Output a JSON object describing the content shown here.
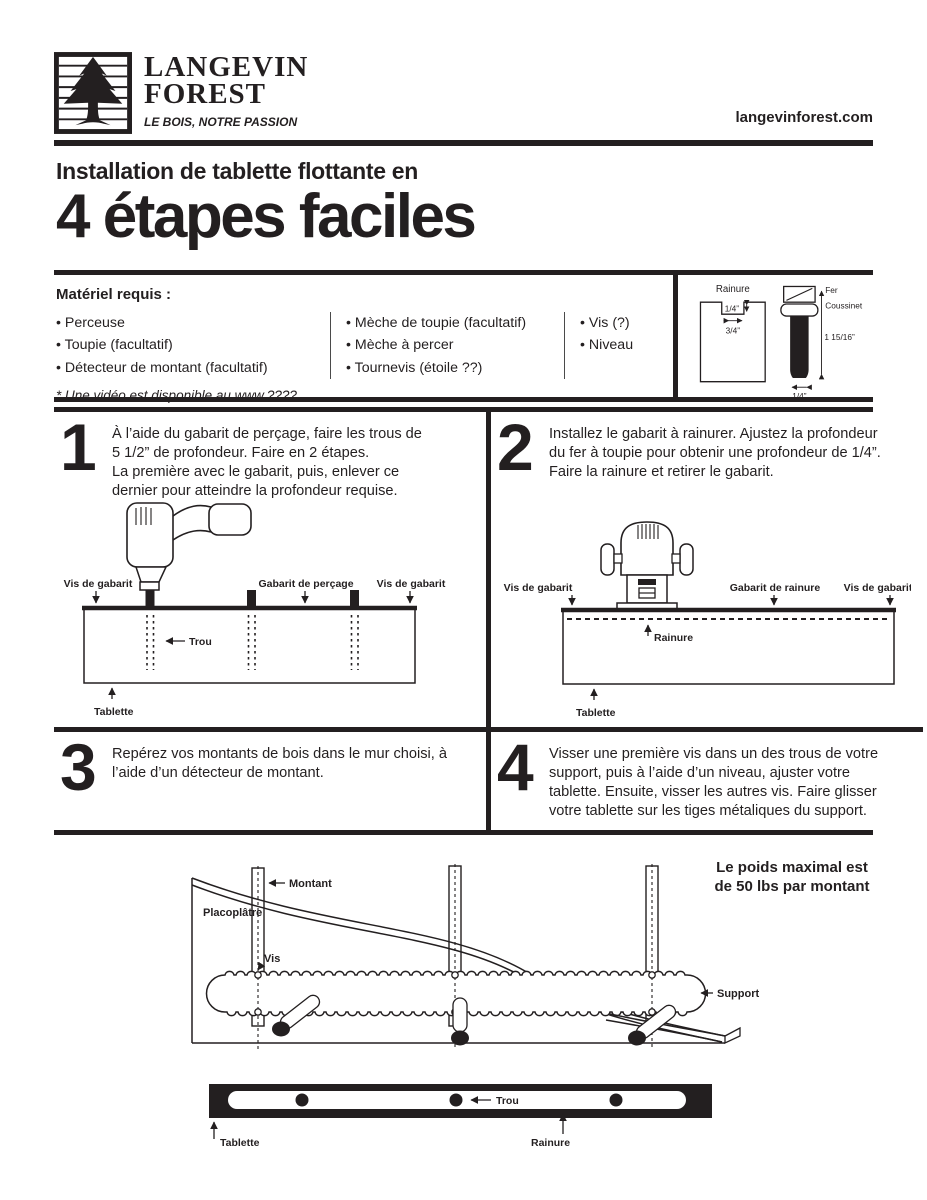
{
  "colors": {
    "ink": "#231f20",
    "paper": "#ffffff"
  },
  "header": {
    "logo_line1": "LANGEVIN",
    "logo_line2": "FOREST",
    "logo_tagline": "LE BOIS, NOTRE PASSION",
    "website": "langevinforest.com"
  },
  "title": {
    "line1": "Installation de tablette flottante en",
    "line2": "4 étapes faciles"
  },
  "materials": {
    "heading": "Matériel requis :",
    "columns": [
      [
        "Perceuse",
        "Toupie (facultatif)",
        "Détecteur de montant (facultatif)"
      ],
      [
        "Mèche de toupie (facultatif)",
        "Mèche à percer",
        "Tournevis (étoile ??)"
      ],
      [
        "Vis (?)",
        "Niveau"
      ]
    ],
    "footnote": "* Une vidéo est disponible au www.????"
  },
  "bit_diagram": {
    "groove_label": "Rainure",
    "groove_depth": "1/4”",
    "groove_width": "3/4”",
    "cutter_label": "Fer",
    "bearing_label": "Coussinet",
    "bit_length": "1 15/16”",
    "tip_width": "1/4”"
  },
  "steps": [
    {
      "number": "1",
      "text": "À l’aide du gabarit de perçage, faire les trous de\n5 1/2” de profondeur. Faire en 2 étapes.\nLa première avec le gabarit, puis, enlever ce\ndernier pour atteindre la profondeur requise."
    },
    {
      "number": "2",
      "text": "Installez le gabarit à rainurer. Ajustez la profondeur\ndu fer à toupie pour obtenir une profondeur de 1/4”.\nFaire la rainure et retirer le gabarit."
    },
    {
      "number": "3",
      "text": "Repérez vos montants de bois dans le mur choisi, à\nl’aide d’un détecteur de montant."
    },
    {
      "number": "4",
      "text": "Visser une première vis dans un des trous de votre\nsupport, puis à l’aide d’un niveau, ajuster votre\ntablette. Ensuite, visser les autres vis. Faire glisser\nvotre tablette sur les tiges métaliques du support."
    }
  ],
  "diagram_step1": {
    "vis_left": "Vis de gabarit",
    "gabarit": "Gabarit de perçage",
    "vis_right": "Vis de gabarit",
    "trou": "Trou",
    "tablette": "Tablette"
  },
  "diagram_step2": {
    "vis_left": "Vis de gabarit",
    "gabarit": "Gabarit de rainure",
    "vis_right": "Vis de gabarit",
    "rainure": "Rainure",
    "tablette": "Tablette"
  },
  "wall_diagram": {
    "montant": "Montant",
    "placoplatre": "Placoplâtre",
    "vis": "Vis",
    "support": "Support",
    "weight_line1": "Le poids maximal est",
    "weight_line2": "de 50 lbs par montant"
  },
  "shelf_diagram": {
    "tablette": "Tablette",
    "trou": "Trou",
    "rainure": "Rainure"
  }
}
